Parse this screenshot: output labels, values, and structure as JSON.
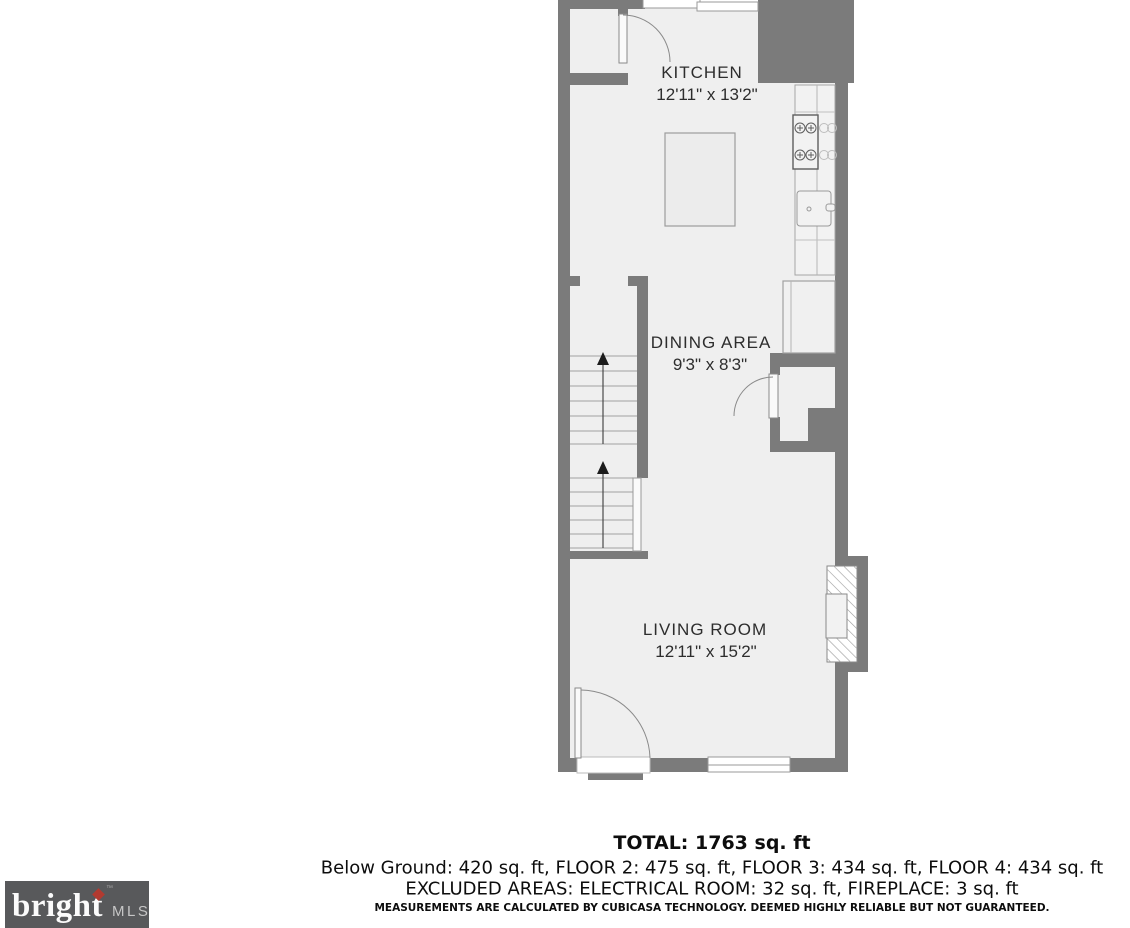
{
  "floorplan": {
    "rooms": [
      {
        "id": "kitchen",
        "name": "KITCHEN",
        "dims": "12'11\" x 13'2\""
      },
      {
        "id": "dining",
        "name": "DINING AREA",
        "dims": "9'3\" x 8'3\""
      },
      {
        "id": "living",
        "name": "LIVING ROOM",
        "dims": "12'11\" x 15'2\""
      }
    ]
  },
  "summary": {
    "total": "TOTAL: 1763 sq. ft",
    "floors": "Below Ground: 420 sq. ft, FLOOR 2: 475 sq. ft, FLOOR 3: 434 sq. ft, FLOOR 4: 434 sq. ft",
    "excluded": "EXCLUDED AREAS: ELECTRICAL ROOM: 32 sq. ft, FIREPLACE: 3 sq. ft",
    "disclaimer": "MEASUREMENTS ARE CALCULATED BY CUBICASA TECHNOLOGY. DEEMED HIGHLY RELIABLE BUT NOT GUARANTEED."
  },
  "logo": {
    "brand": "bright",
    "tm": "™",
    "suffix": "MLS"
  },
  "colors": {
    "wall": "#7b7b7b",
    "floor": "#efefef",
    "logo_bg": "#58595b",
    "logo_diamond": "#b23a30"
  }
}
